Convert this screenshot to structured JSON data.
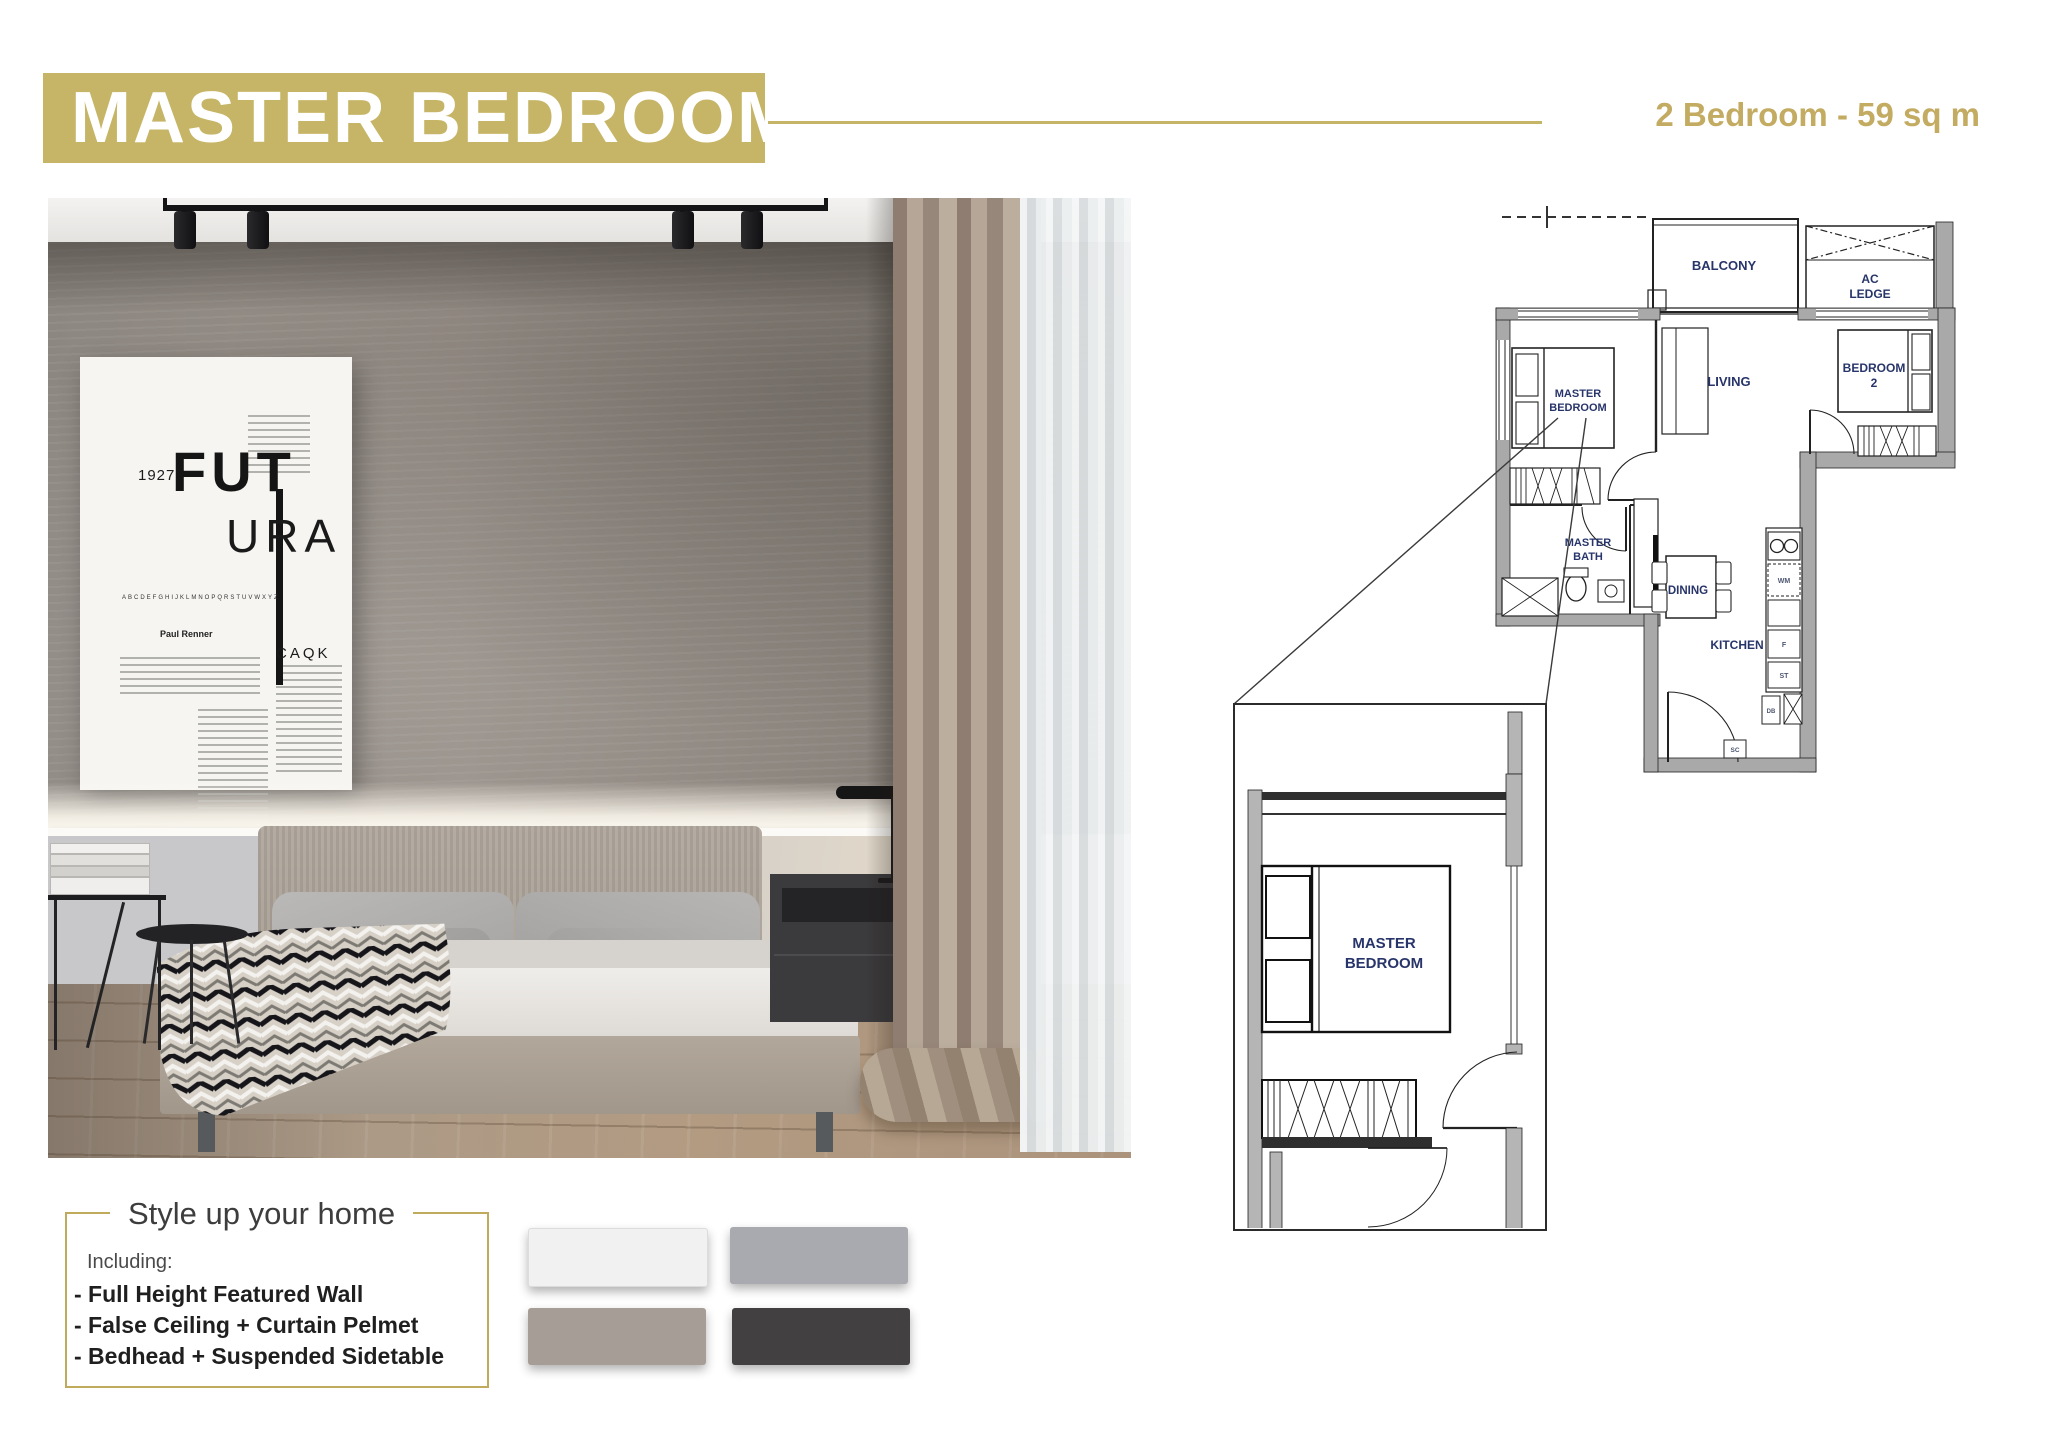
{
  "header": {
    "title": "MASTER BEDROOM",
    "subtitle": "2 Bedroom - 59 sq m"
  },
  "photo": {
    "poster": {
      "year": "1927",
      "fut": "FUT",
      "ura": "URA",
      "alphabet": "ABCDEFGHIJKLMNOPQRSTUVWXYZ",
      "designer": "Paul Renner",
      "caqk": "CAQK"
    }
  },
  "floor_plan": {
    "rooms": {
      "balcony": "BALCONY",
      "ac1": "AC",
      "ac2": "LEDGE",
      "living": "LIVING",
      "br2a": "BEDROOM",
      "br2b": "2",
      "mb1": "MASTER",
      "mb2": "BEDROOM",
      "bath1": "MASTER",
      "bath2": "BATH",
      "dining": "DINING",
      "kitchen": "KITCHEN"
    },
    "appliances": {
      "wm": "WM",
      "f": "F",
      "st": "ST",
      "db": "DB",
      "sc": "SC"
    },
    "detail": {
      "d1": "MASTER",
      "d2": "BEDROOM"
    }
  },
  "style_panel": {
    "title": "Style up your home",
    "including": "Including:",
    "items": [
      "- Full Height Featured Wall",
      "- False Ceiling + Curtain Pelmet",
      "- Bedhead + Suspended Sidetable"
    ]
  },
  "swatches": [
    {
      "name": "off-white",
      "color": "#f1f1f2"
    },
    {
      "name": "light-gray",
      "color": "#a9aab0"
    },
    {
      "name": "taupe",
      "color": "#a69d96"
    },
    {
      "name": "charcoal",
      "color": "#434042"
    }
  ],
  "colors": {
    "accent_gold": "#c6b566",
    "plan_label_navy": "#28356a"
  }
}
